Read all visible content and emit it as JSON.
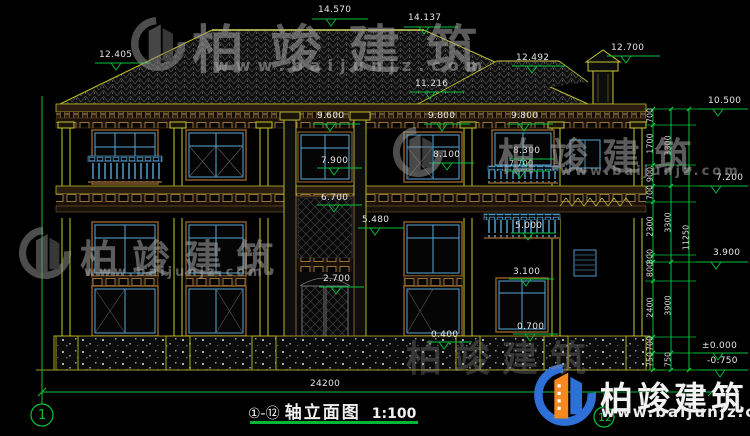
{
  "watermark": {
    "brand": "柏竣建筑",
    "url": "www.baijunjz.com"
  },
  "title": {
    "axes": "①-⑫",
    "name": "轴立面图",
    "scale": "1:100"
  },
  "axis_bubbles": {
    "left": "1",
    "right": "12"
  },
  "dimensions": {
    "total_width": "24200",
    "right_total": "11250",
    "right_inner": [
      "700",
      "1700",
      "900",
      "700",
      "2300",
      "300",
      "800",
      "2400",
      "700",
      "750"
    ],
    "right_middle": [
      "3300",
      "3300",
      "3900",
      "750"
    ]
  },
  "levels": {
    "ridge_main": "14.570",
    "ridge_second": "14.137",
    "roof_left": "12.405",
    "roof_right": "12.492",
    "chimney": "12.700",
    "roof_mid": "11.216",
    "parapet": "10.500",
    "eave_left": "9.600",
    "eave_mid": "9.800",
    "eave_right": "9.800",
    "win2_left": "7.900",
    "win2_mid": "8.100",
    "win2_right": "8.300",
    "rail2_right": "7.700",
    "floor2_top": "7.200",
    "band_mid": "6.700",
    "door_head_upper": "5.480",
    "rail1_right": "5.000",
    "floor2": "3.900",
    "win1_head": "3.100",
    "door_head": "2.700",
    "win1_sill": "0.700",
    "win1_sill_left": "0.400",
    "ground": "±0.000",
    "base": "-0.750"
  }
}
